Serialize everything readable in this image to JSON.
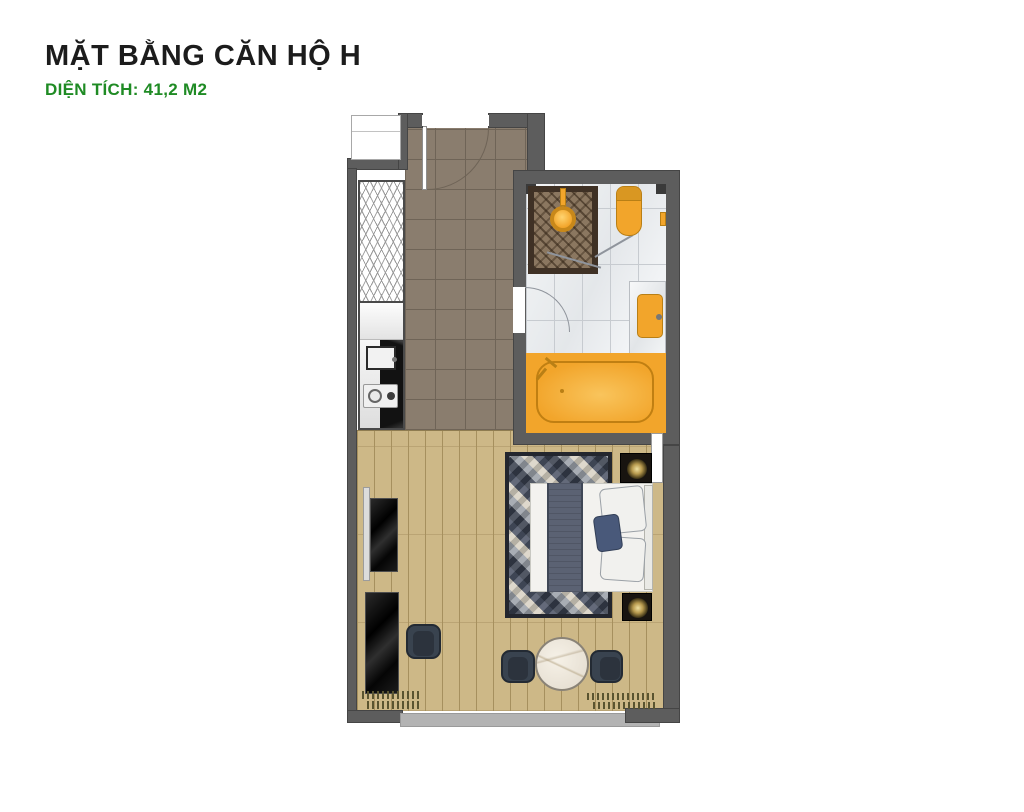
{
  "header": {
    "title": "MẶT BẰNG CĂN HỘ H",
    "subtitle": "DIỆN TÍCH: 41,2 M2"
  },
  "palette": {
    "title_color": "#1c1c1c",
    "subtitle_color": "#1f8b24",
    "wall": "#5d5d5d",
    "wall_dark": "#454545",
    "hall_tile": "#8a7d6e",
    "hall_line": "#6f6457",
    "wood": "#cdb887",
    "wood_line": "#a6905e",
    "marble_line": "#c7cbd0",
    "accent_gold": "#f2a52b",
    "gold_dark": "#b97f15",
    "shower_brown": "#8b7760",
    "shower_frame": "#3f3125",
    "navy": "#39434f",
    "navy_pillow": "#49597a",
    "runner": "#5b6273",
    "curtain": "#5a5430",
    "sill": "#b3b3b3"
  }
}
